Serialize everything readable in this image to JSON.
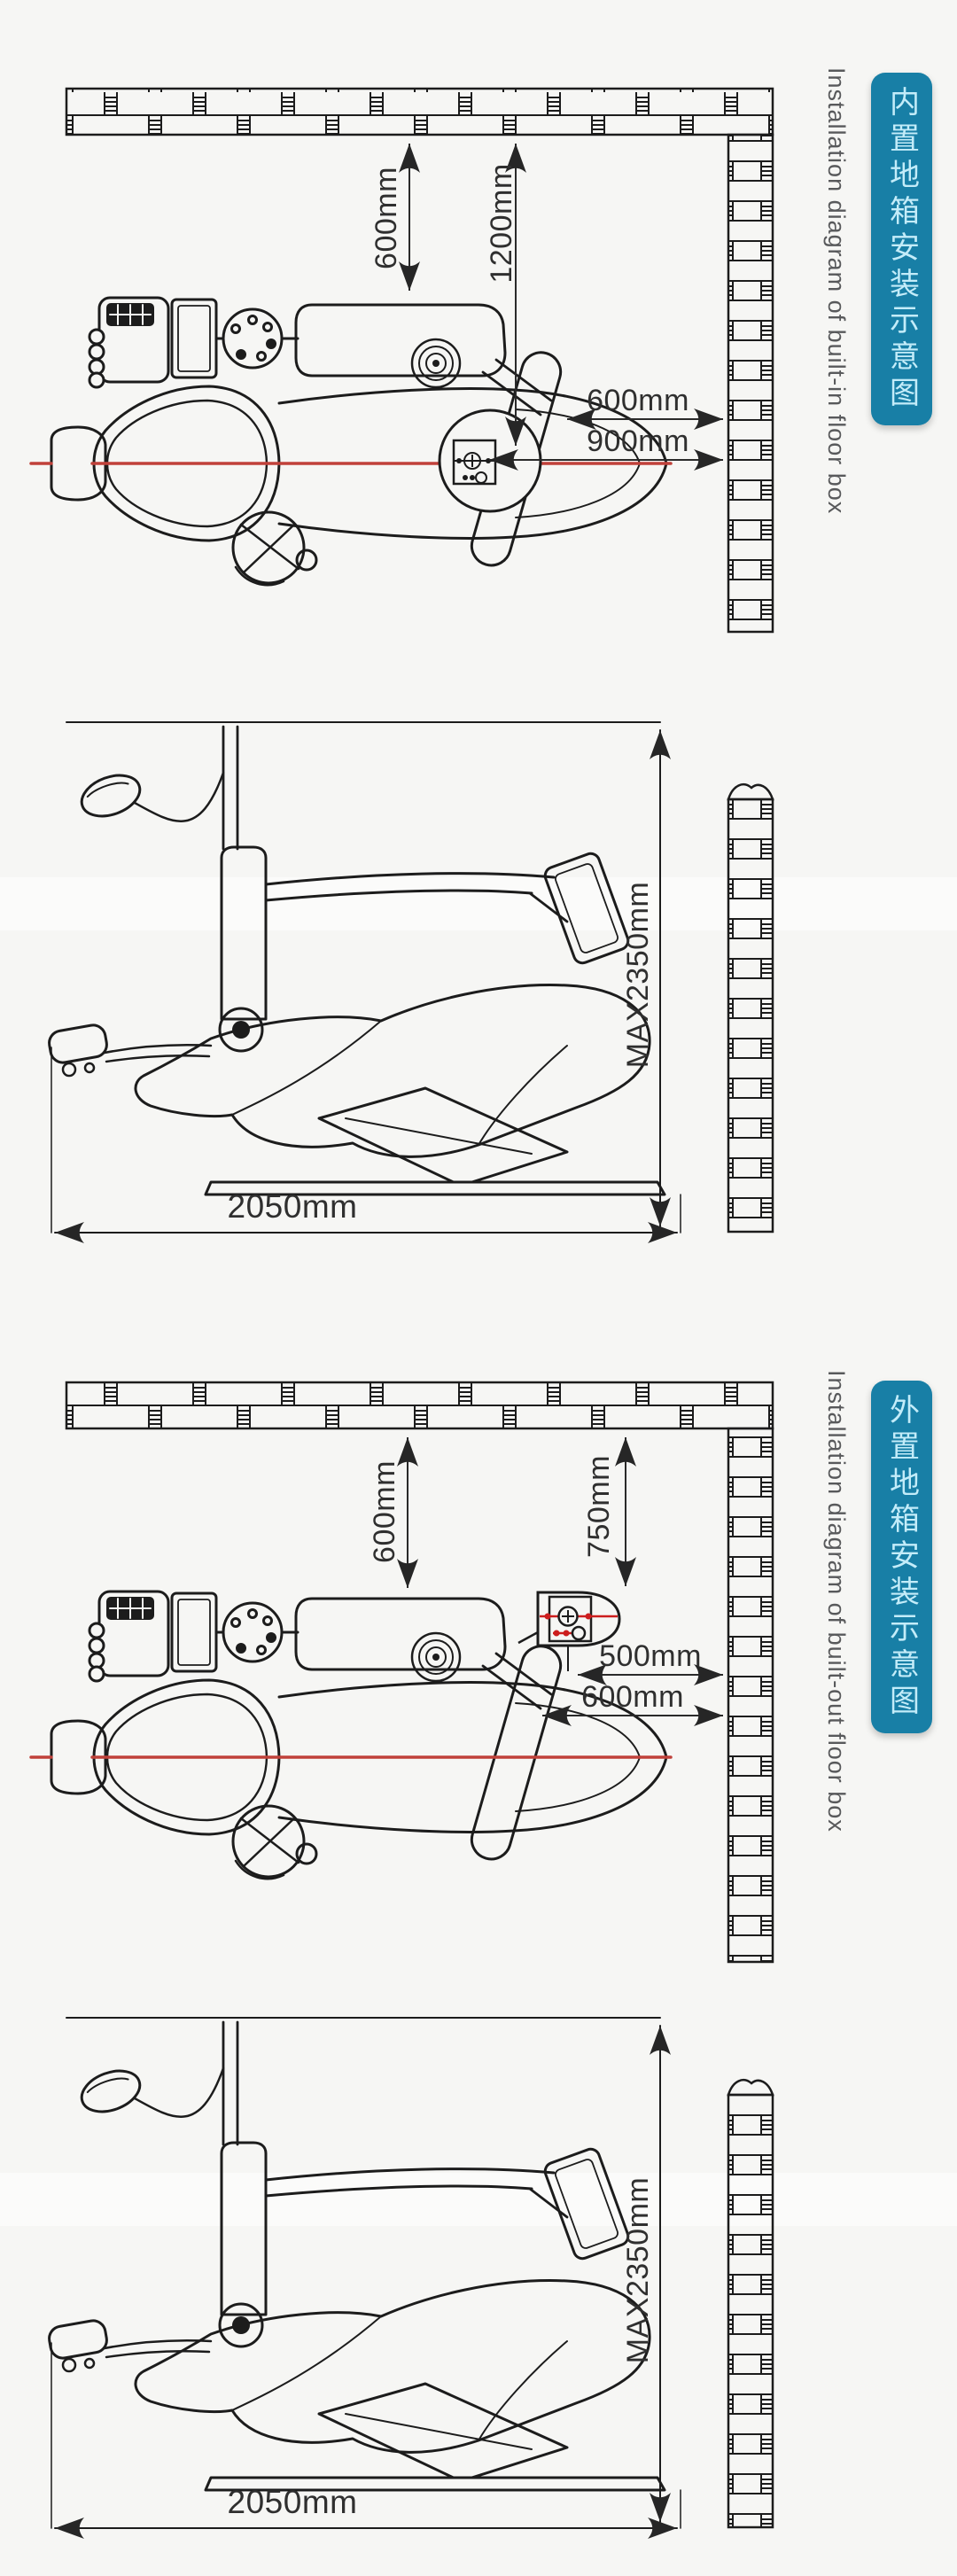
{
  "page": {
    "title": "Dental unit floor box installation diagrams",
    "colors": {
      "background": "#f6f6f4",
      "line": "#1c1c1c",
      "teal": "#187fa6",
      "teal_text": "#c3ecf9",
      "english_text": "#58595b",
      "red_centerline": "#c0413a",
      "red_symbol": "#cc1d1d",
      "dim_text": "#2f2f2f"
    },
    "icon_names": [
      "brick-wall",
      "dental-chair-top-view",
      "dental-chair-side-view",
      "floor-box-symbol",
      "dental-light",
      "arrow-head"
    ]
  },
  "sections": [
    {
      "id": "built_in",
      "side_label_cn": "内置地箱安装示意图",
      "side_label_en": "Installation diagram of built-in floor box",
      "top_view": {
        "dim_wall_to_chair": "600mm",
        "dim_wall_to_floorbox_v": "1200mm",
        "dim_chair_to_wall": "600mm",
        "dim_floorbox_to_wall": "900mm"
      },
      "side_view": {
        "dim_max_height": "MAX2350mm",
        "dim_length": "2050mm"
      }
    },
    {
      "id": "built_out",
      "side_label_cn": "外置地箱安装示意图",
      "side_label_en": "Installation diagram of built-out floor box",
      "top_view": {
        "dim_wall_to_chair": "600mm",
        "dim_wall_to_floorbox_v": "750mm",
        "dim_floorbox_to_wall": "500mm",
        "dim_chair_to_wall": "600mm"
      },
      "side_view": {
        "dim_max_height": "MAX2350mm",
        "dim_length": "2050mm"
      }
    }
  ]
}
